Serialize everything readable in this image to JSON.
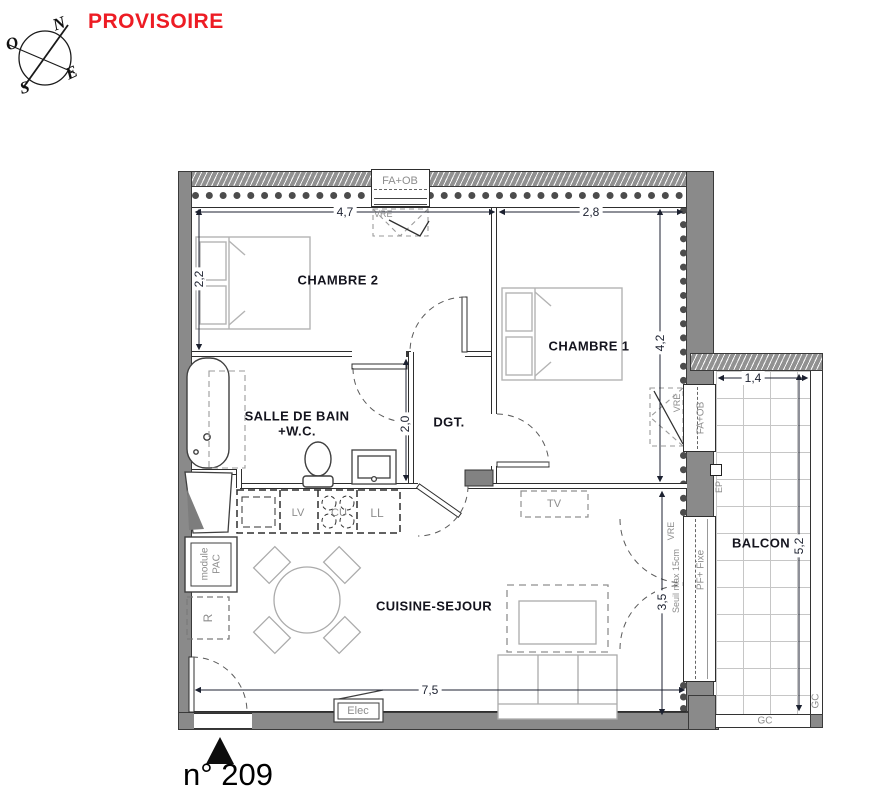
{
  "header": {
    "provisoire": "PROVISOIRE"
  },
  "colors": {
    "accent_red": "#ed1c24",
    "wall_gray": "#8a8a8a"
  },
  "compass": {
    "n": "N",
    "o": "O",
    "e": "E",
    "s": "S"
  },
  "rooms": {
    "chambre2": "CHAMBRE 2",
    "chambre1": "CHAMBRE 1",
    "sdb1": "SALLE DE BAIN",
    "sdb2": "+W.C.",
    "dgt": "DGT.",
    "sejour": "CUISINE-SEJOUR",
    "balcon": "BALCON"
  },
  "dims": {
    "ch2_w": "4,7",
    "ch2_d": "2,2",
    "ch1_w": "2,8",
    "ch1_d": "4,2",
    "sdb_d": "2,0",
    "sej_w": "7,5",
    "sej_d": "3,5",
    "bal_w": "1,4",
    "bal_d": "5,2"
  },
  "tags": {
    "fa_ob_top": "FA+OB",
    "vre_top": "VRE",
    "fa_ob_right": "FA+OB",
    "vre_right": "VRE",
    "pf_fixe": "PF+ Fixe",
    "vre_balcony": "VRE",
    "seuil": "Seuil max 15cm",
    "ep": "EP",
    "gc_bottom": "GC",
    "gc_right": "GC",
    "tv": "TV",
    "elec": "Elec",
    "lv": "LV",
    "cu": "CU",
    "ll": "LL",
    "module1": "module",
    "module2": "PAC",
    "r": "R"
  },
  "unit": {
    "number": "n° 209"
  }
}
